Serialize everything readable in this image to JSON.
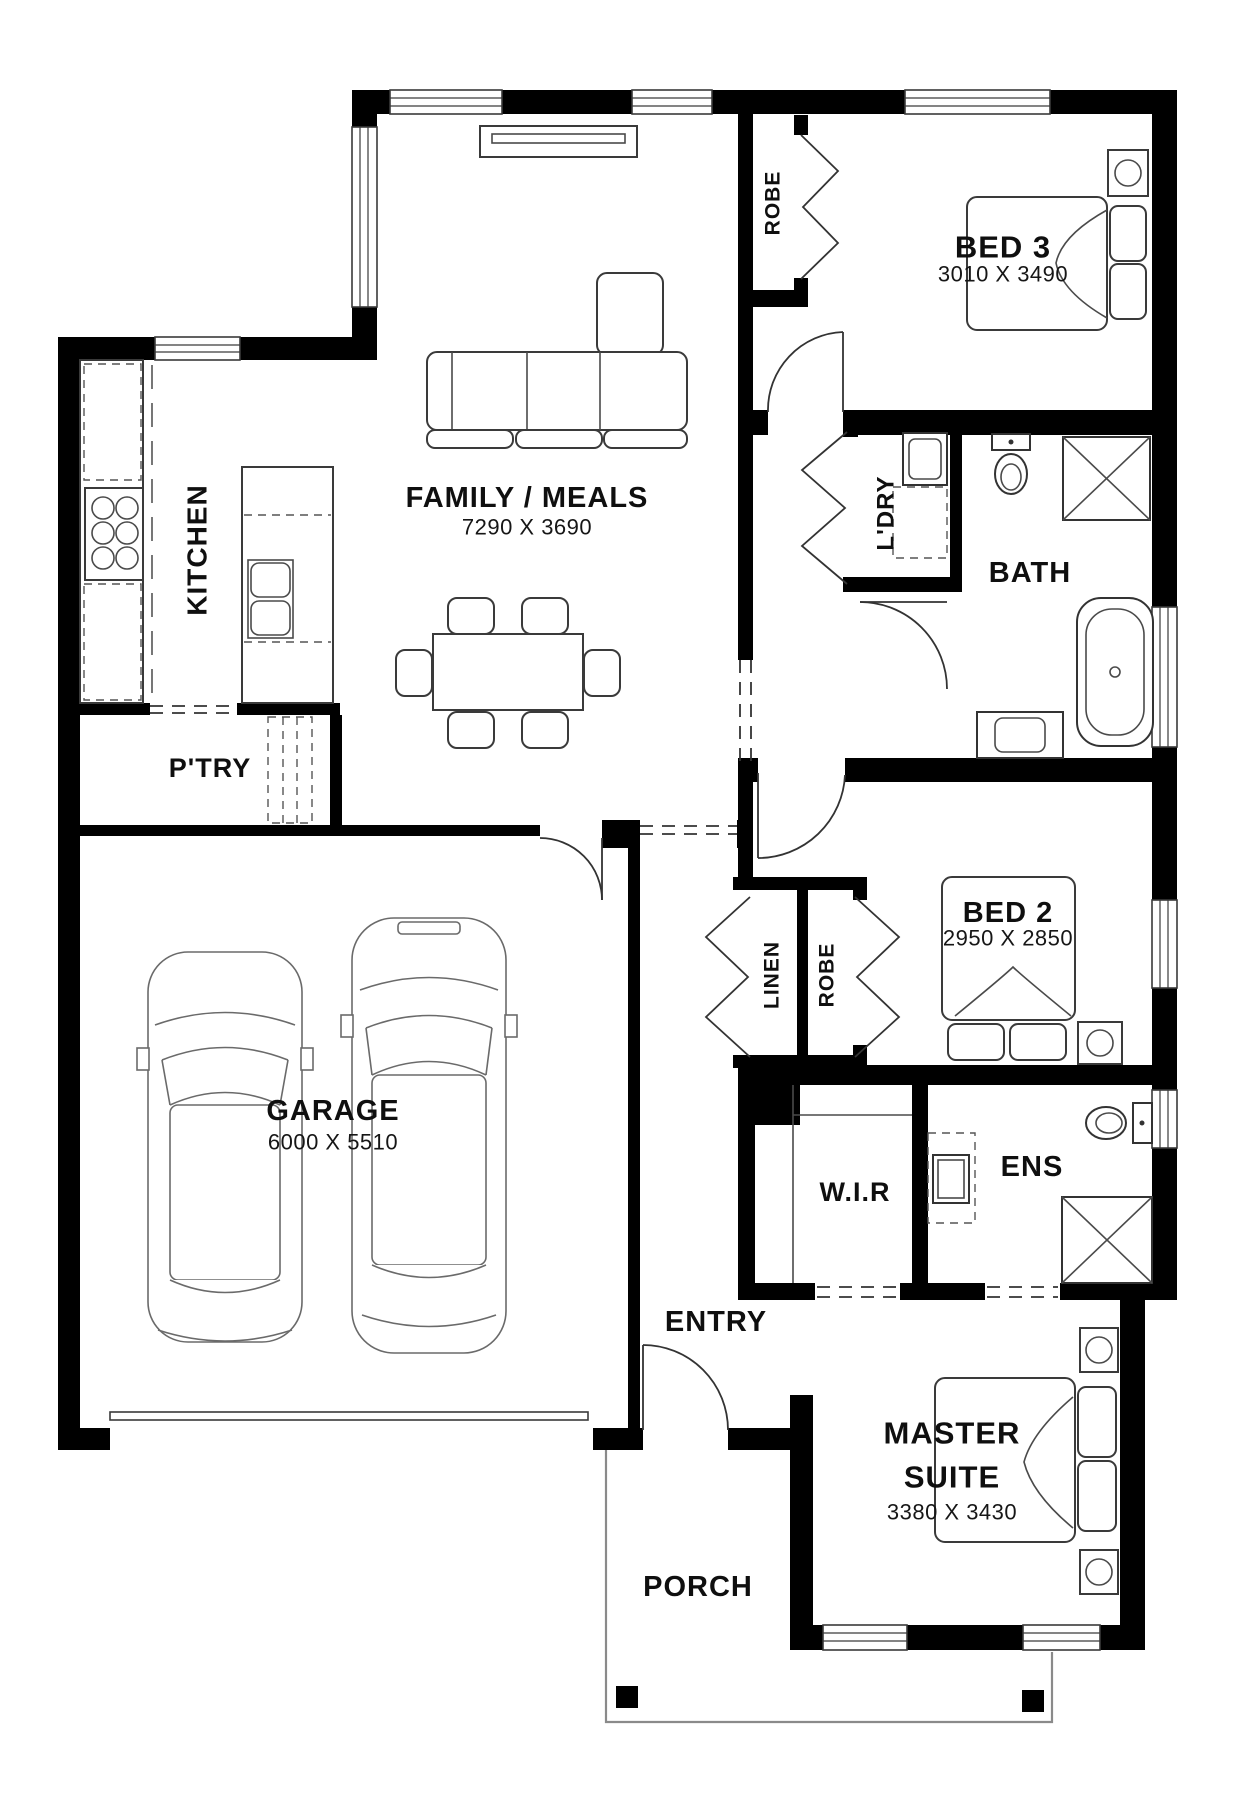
{
  "page": {
    "background": "#ffffff",
    "type": "architectural-floor-plan"
  },
  "colors": {
    "wall": "#000000",
    "fixture_line": "#333333",
    "furniture_line": "#4a4a4a",
    "car_line": "#6a6a6a",
    "porch_line": "#8a8a8a",
    "text": "#0f0f0f"
  },
  "rooms": {
    "family": {
      "label": "FAMILY / MEALS",
      "dims": "7290 X 3690"
    },
    "kitchen": {
      "label": "KITCHEN"
    },
    "pantry": {
      "label": "P'TRY"
    },
    "garage": {
      "label": "GARAGE",
      "dims": "6000 X 5510"
    },
    "robe_bed3": {
      "label": "ROBE"
    },
    "bed3": {
      "label": "BED 3",
      "dims": "3010 X 3490"
    },
    "laundry": {
      "label": "L'DRY"
    },
    "bath": {
      "label": "BATH"
    },
    "bed2": {
      "label": "BED 2",
      "dims": "2950 X 2850"
    },
    "linen": {
      "label": "LINEN"
    },
    "robe_bed2": {
      "label": "ROBE"
    },
    "wir": {
      "label": "W.I.R"
    },
    "ens": {
      "label": "ENS"
    },
    "entry": {
      "label": "ENTRY"
    },
    "master": {
      "label_line1": "MASTER",
      "label_line2": "SUITE",
      "dims": "3380 X 3430"
    },
    "porch": {
      "label": "PORCH"
    }
  }
}
